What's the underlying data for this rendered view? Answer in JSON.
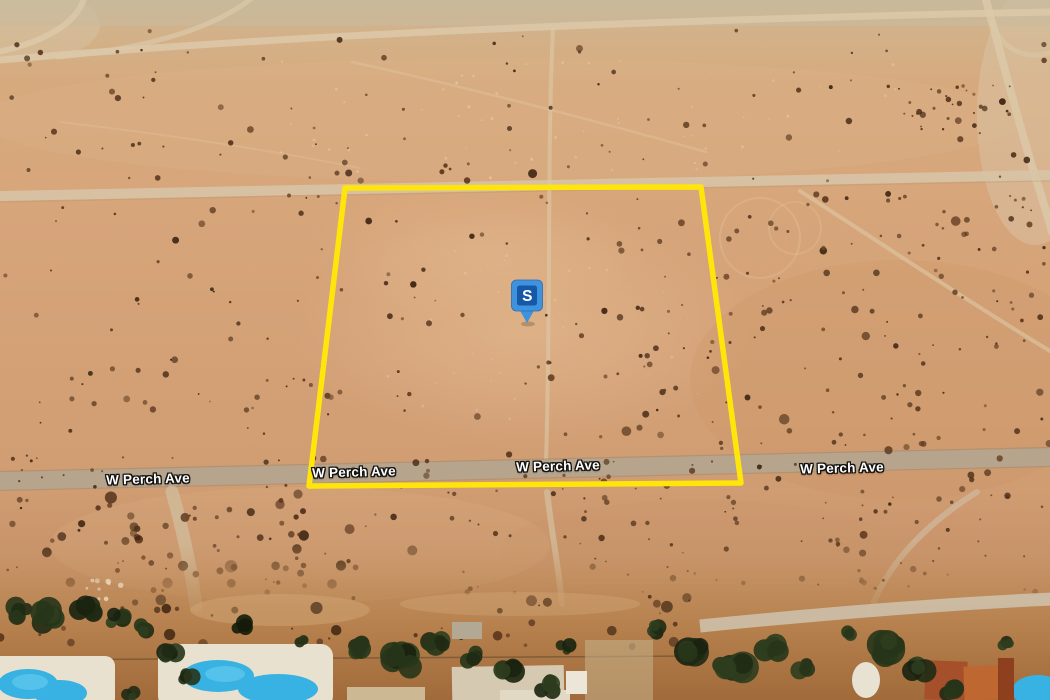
{
  "map": {
    "street_labels": [
      {
        "text": "W Perch Ave"
      },
      {
        "text": "W Perch Ave"
      },
      {
        "text": "W Perch Ave"
      },
      {
        "text": "W Perch Ave"
      }
    ],
    "marker": {
      "label": "S"
    },
    "parcel": {
      "points": "345,188 701,187 741,483 309,486"
    },
    "colors": {
      "parcel_outline": "#ffe50a",
      "marker_body": "#3f93dd",
      "marker_inner": "#1558a8",
      "marker_letter": "#ffffff",
      "street_label_text": "#ffffff",
      "pool_water": "#38b2e2"
    }
  }
}
